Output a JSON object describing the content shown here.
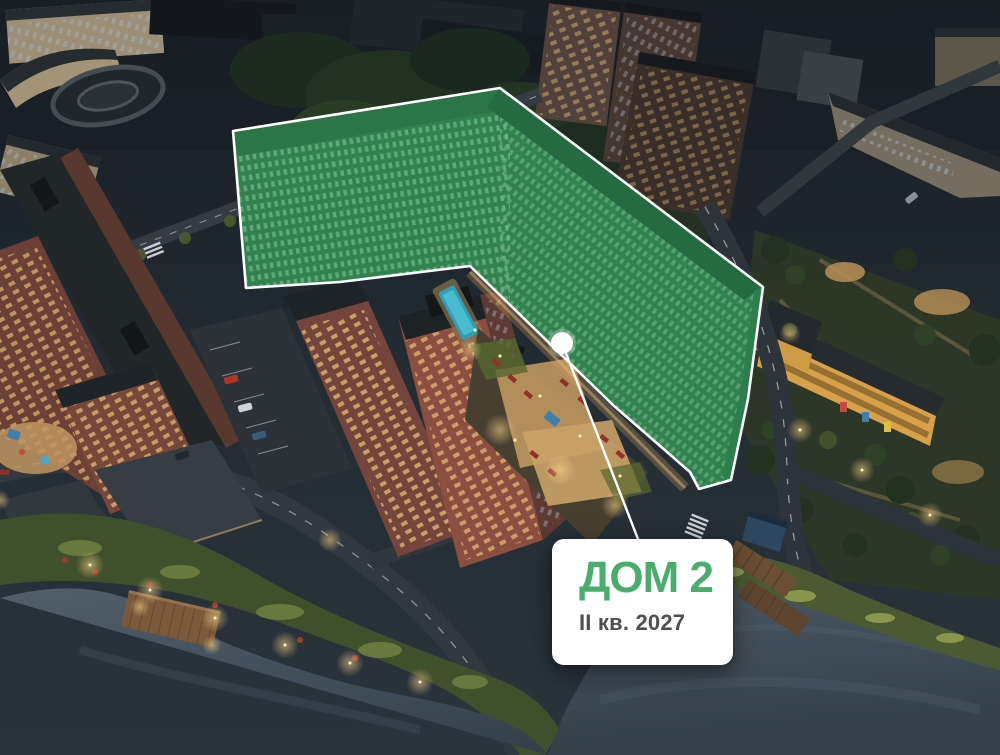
{
  "callout": {
    "title": "ДОМ 2",
    "subtitle": "II кв. 2027"
  },
  "highlight": {
    "building_label": "ДОМ 2",
    "overlay_green": "#3fa566",
    "outline_white": "#ffffff"
  },
  "colors": {
    "accent_green": "#4aad6d",
    "subtitle_gray": "#4f4f4f",
    "card_bg": "#ffffff",
    "water": "#46525d",
    "night_ground": "#232b33"
  }
}
